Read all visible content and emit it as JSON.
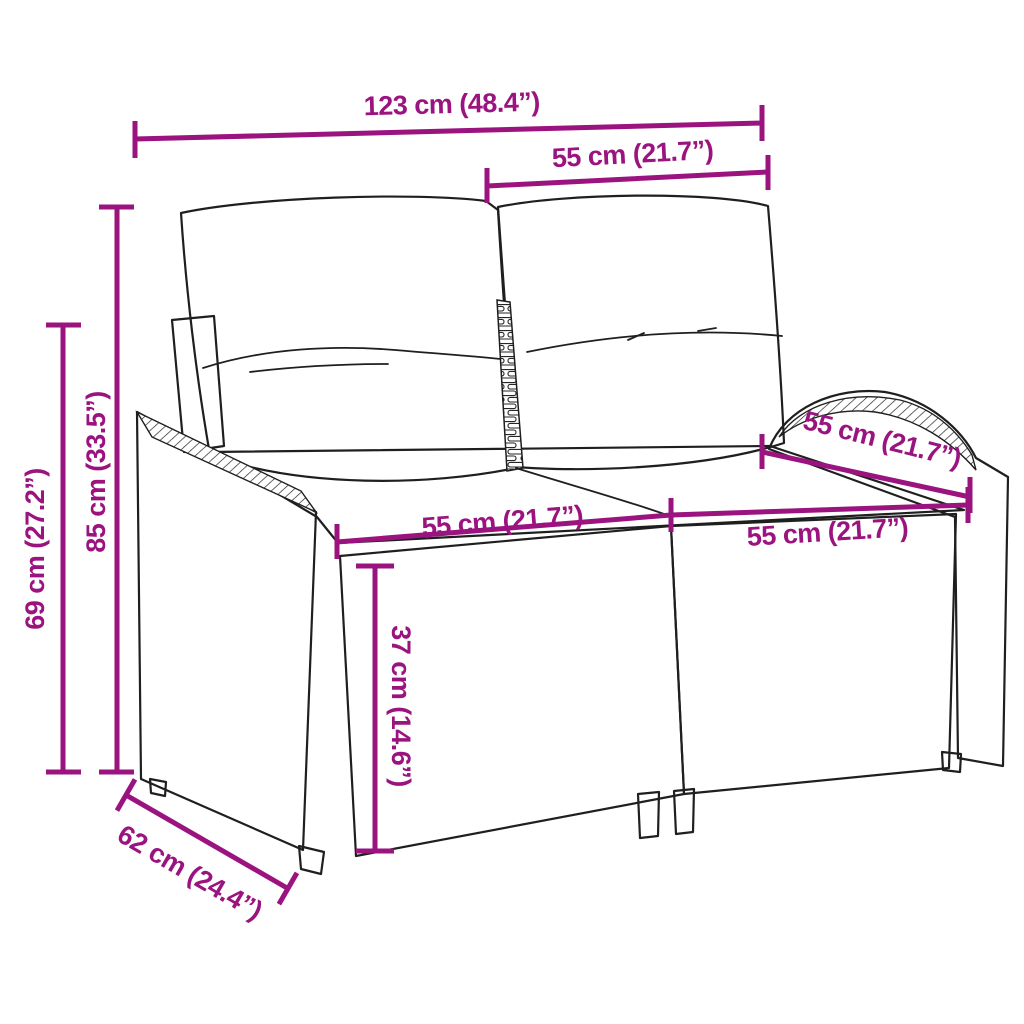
{
  "diagram": {
    "subject": "Poly rattan two-seater garden sofa with cushions — dimension drawing",
    "accent_color": "#9A137F",
    "outline_color": "#1F1F1F",
    "background_color": "#FFFFFF",
    "dimensions": {
      "overall_width": "123 cm (48.4”)",
      "backrest_section_width": "55 cm (21.7”)",
      "overall_height": "85 cm (33.5”)",
      "armrest_height": "69 cm (27.2”)",
      "backrest_depth": "55 cm (21.7”)",
      "seat_width_left": "55 cm (21.7”)",
      "seat_width_right": "55 cm (21.7”)",
      "seat_height": "37 cm (14.6”)",
      "overall_depth": "62 cm (24.4”)"
    }
  }
}
